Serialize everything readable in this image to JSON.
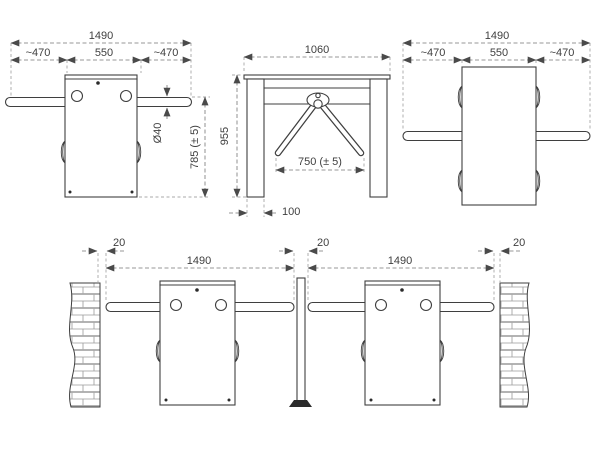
{
  "drawing": {
    "title": "Tripod turnstile dimensional drawing",
    "colors": {
      "line": "#3f3f3f",
      "dimension": "#767676",
      "background": "#ffffff",
      "brick": "#9a9a9a"
    },
    "top_view_left": {
      "overall_width": "1490",
      "left_arm_length": "~470",
      "cabinet_width": "550",
      "right_arm_length": "~470",
      "arm_diameter": "Ø40",
      "arm_height": "785 (± 5)"
    },
    "front_view": {
      "overall_width": "1060",
      "overall_height": "955",
      "arm_clear_span": "750 (± 5)",
      "leg_width": "100"
    },
    "top_view_right": {
      "overall_width": "1490",
      "left_arm_length": "~470",
      "cabinet_width": "550",
      "right_arm_length": "~470"
    },
    "layout_view": {
      "left_wall_gap": "20",
      "lane1_width": "1490",
      "center_gap": "20",
      "lane2_width": "1490",
      "right_wall_gap": "20"
    }
  }
}
